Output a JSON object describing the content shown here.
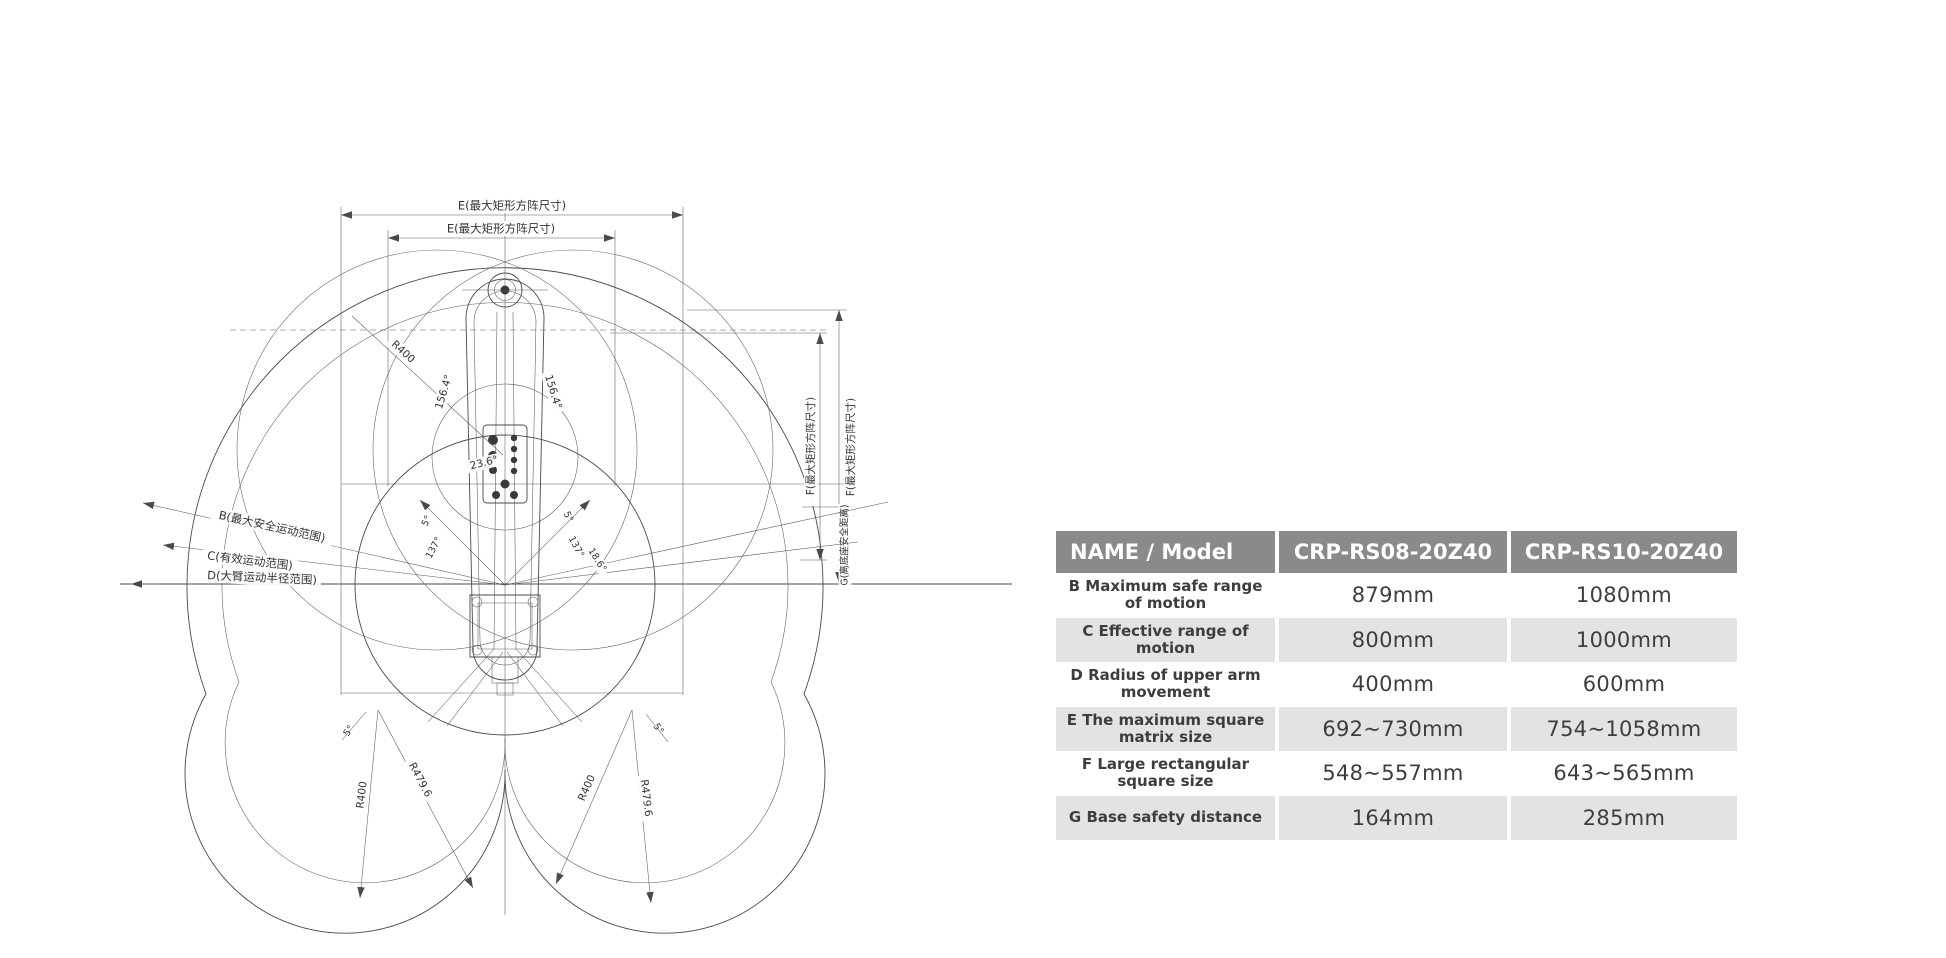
{
  "diagram": {
    "labels": {
      "e_max_square": "E(最大矩形方阵尺寸)",
      "f_max_square": "F(最大矩形方阵尺寸)",
      "g_base_safety": "G(离底座安全距离)",
      "b_max_safe_range": "B(最大安全运动范围)",
      "c_effective_range": "C(有效运动范围)",
      "d_arm_radius_range": "D(大臂运动半径范围)"
    },
    "radii": {
      "r400": "R400",
      "r479_6": "R479.6"
    },
    "angles": {
      "a156_4": "156.4°",
      "a23_6": "23.6°",
      "a137": "137°",
      "a5": "5°",
      "a18_6": "18.6°"
    }
  },
  "table": {
    "headers": [
      "NAME / Model",
      "CRP-RS08-20Z40",
      "CRP-RS10-20Z40"
    ],
    "rows": [
      {
        "name": "B Maximum safe range of motion",
        "rs08": "879mm",
        "rs10": "1080mm"
      },
      {
        "name": "C Effective range of motion",
        "rs08": "800mm",
        "rs10": "1000mm"
      },
      {
        "name": "D Radius of upper arm movement",
        "rs08": "400mm",
        "rs10": "600mm"
      },
      {
        "name": "E The maximum square matrix size",
        "rs08": "692~730mm",
        "rs10": "754~1058mm"
      },
      {
        "name": "F Large rectangular square size",
        "rs08": "548~557mm",
        "rs10": "643~565mm"
      },
      {
        "name": "G Base safety distance",
        "rs08": "164mm",
        "rs10": "285mm"
      }
    ],
    "colors": {
      "header_bg": "#8a8a8a",
      "header_text": "#ffffff",
      "alt_row_bg": "#e3e3e3",
      "body_text": "#3d3d3d"
    }
  }
}
